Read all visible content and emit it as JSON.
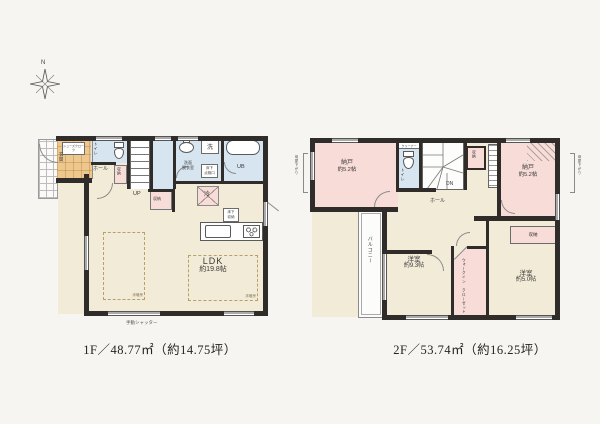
{
  "compass": {
    "north": "N"
  },
  "palette": {
    "background": "#f6f5f2",
    "wall": "#2f2c2a",
    "room_cream": "#f2ebd8",
    "wet_blue": "#d7e5f0",
    "storage_pink": "#f8dcd8",
    "entrance_orange": "#eec78f"
  },
  "floor1": {
    "caption": "1F／48.77㎡（約14.75坪）",
    "shutter_note": "手動シャッター",
    "rooms": {
      "shoes": "シューズクローク",
      "genkan": "玄関",
      "toilet": "トイレ",
      "hall": "ホール",
      "hall_closet": "収納",
      "stairs": "UP",
      "under_stair_closet": "収納",
      "wash1": "洗面",
      "wash2": "脱衣室",
      "laundry": "洗",
      "inspection1": "床下",
      "inspection2": "点検口",
      "bath": "UB",
      "fridge": "冷",
      "underfloor1": "床下",
      "underfloor2": "収納",
      "ldk": "LDK",
      "ldk_size": "約19.8帖",
      "floor_heating": "床暖房"
    }
  },
  "floor2": {
    "caption": "2F／53.74㎡（約16.25坪）",
    "rooms": {
      "nando_l": "納戸",
      "nando_l_size": "約5.2帖",
      "toilet_shelf": "クリーナー",
      "toilet": "トイレ",
      "stairs": "DN",
      "hall": "ホール",
      "stair_closet": "収納",
      "nando_r": "納戸",
      "nando_r_size": "約5.2帖",
      "eaves_left": "母屋下がり",
      "eaves_right": "母屋下がり",
      "balcony": "バルコニー",
      "bed1": "洋室",
      "bed1_size": "約9.3帖",
      "wic1": "ウォークイン",
      "wic2": "クローゼット",
      "closet_wide": "収納",
      "bed2": "洋室",
      "bed2_size": "約5.0帖"
    }
  }
}
